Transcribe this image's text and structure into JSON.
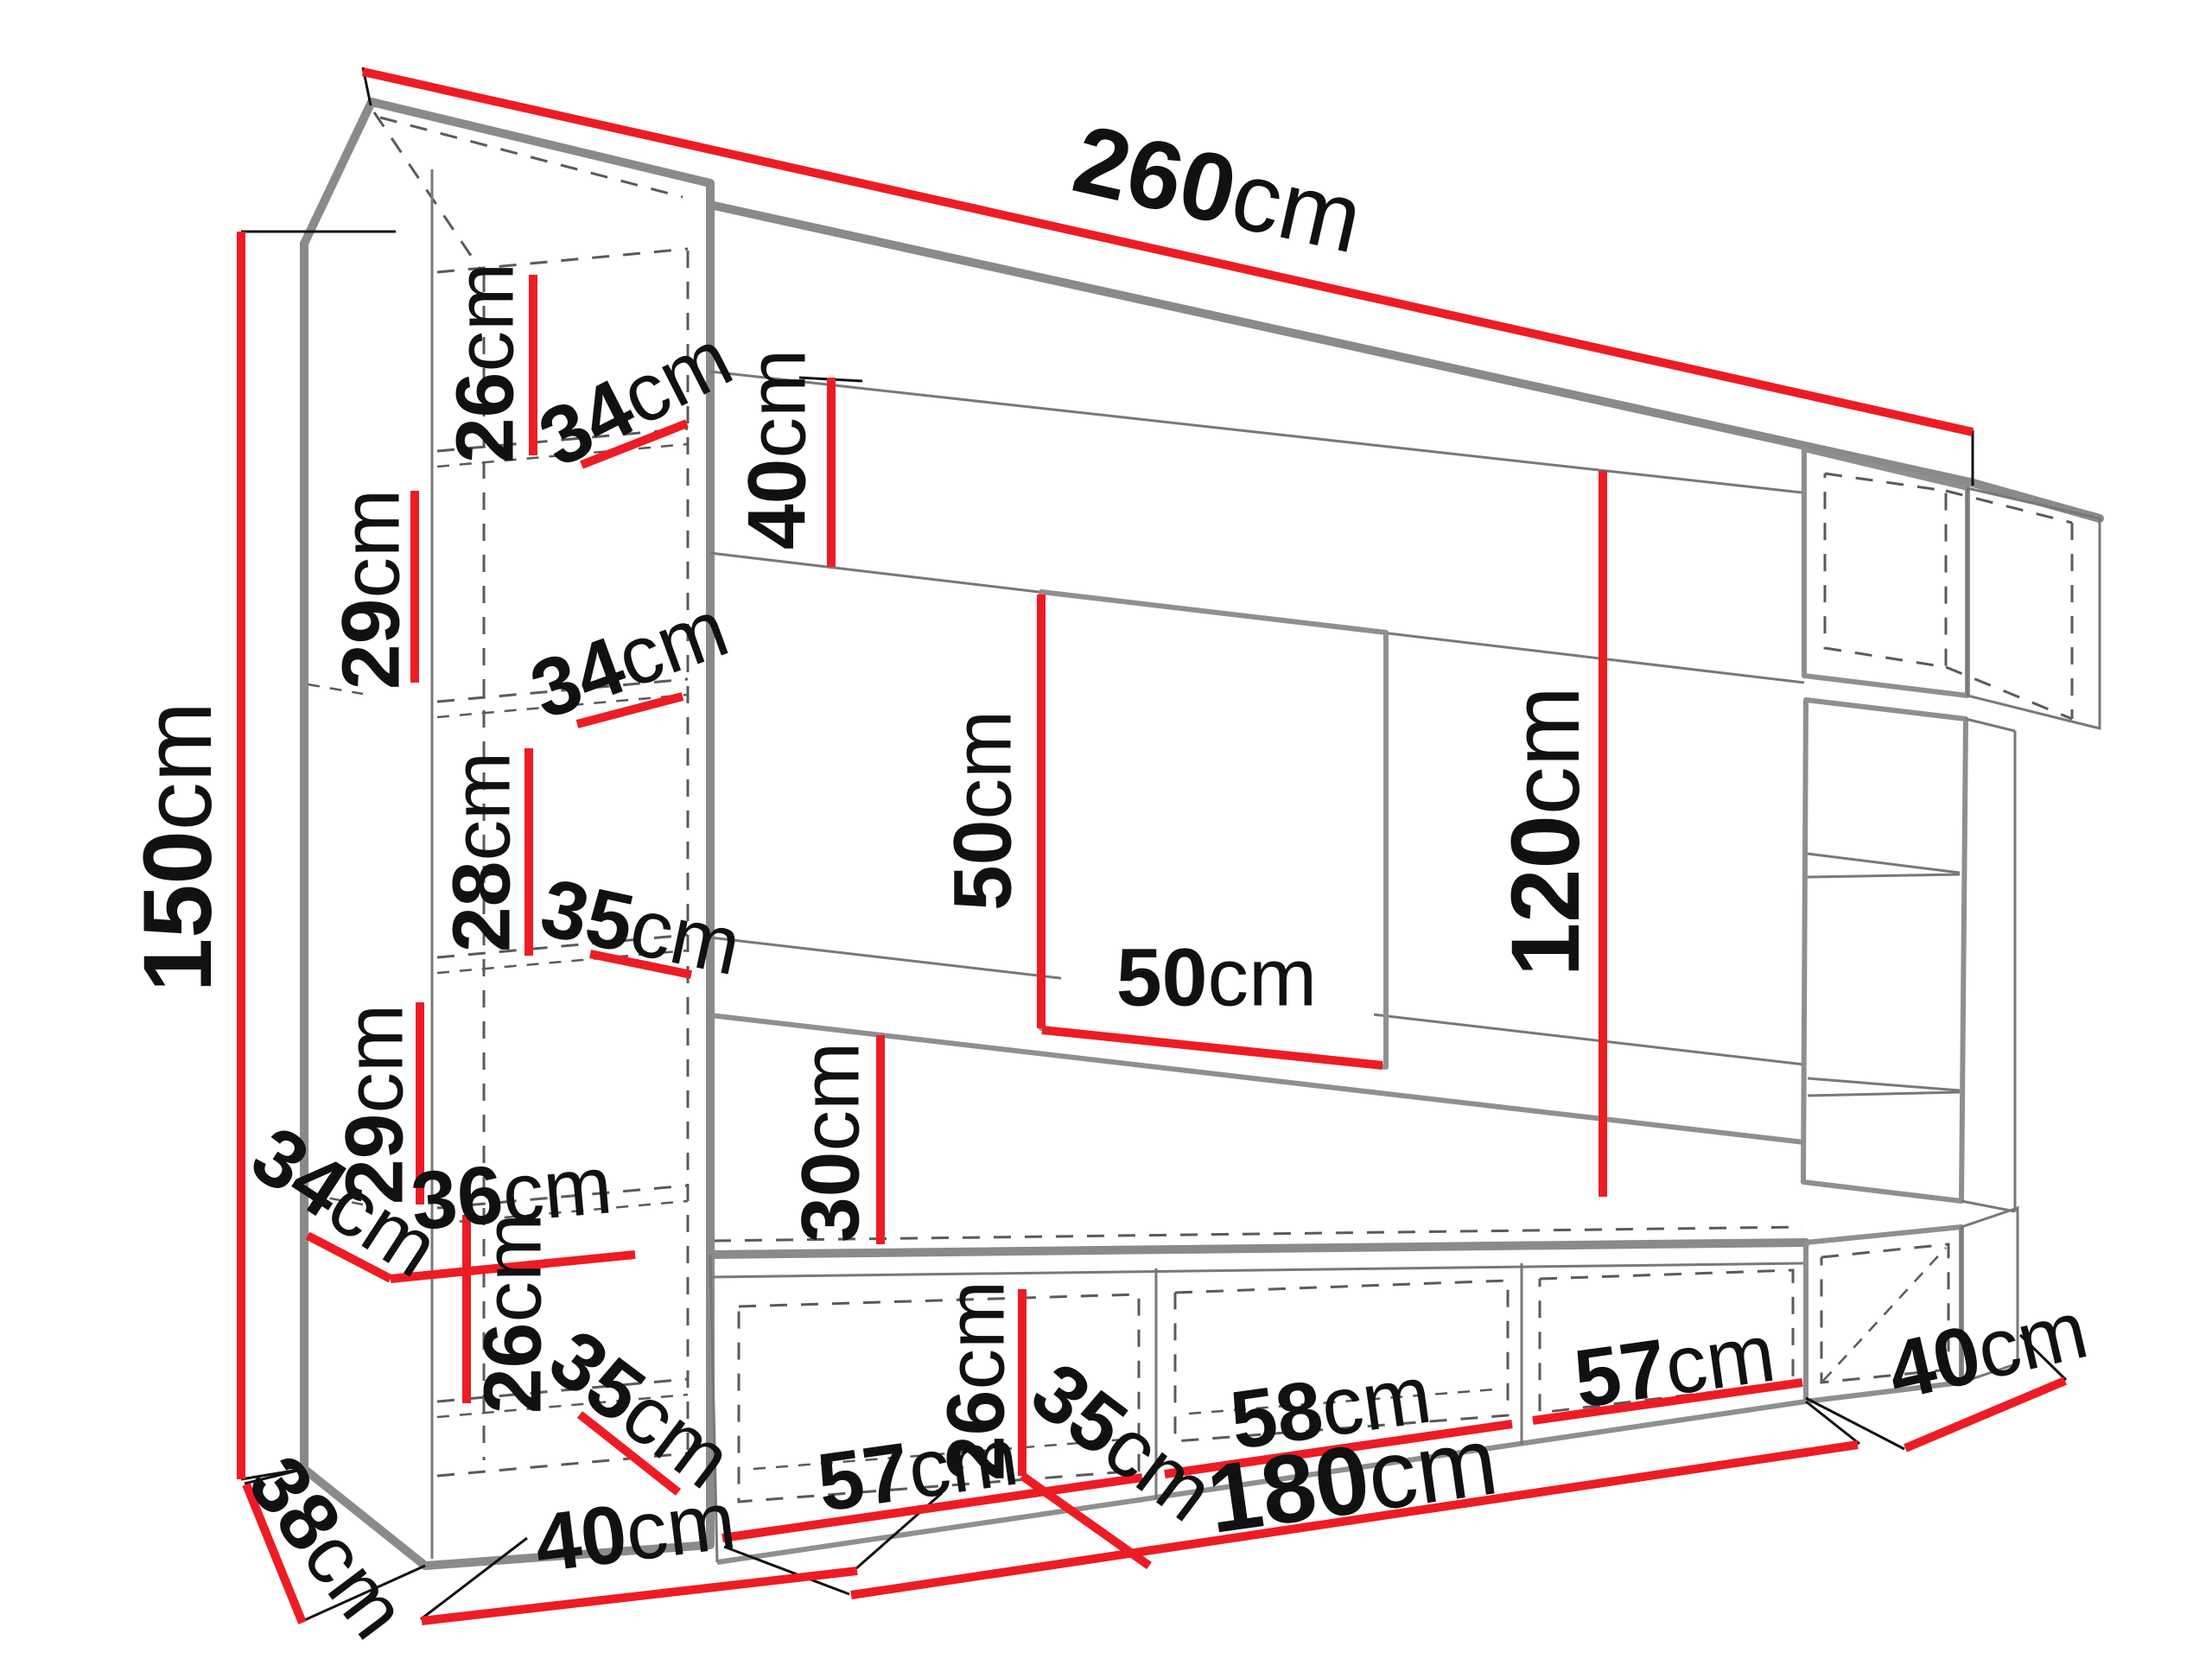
{
  "title": "Wall unit dimension diagram",
  "colors": {
    "dimension_line": "#ED1C24",
    "structure": "#8A8A8A",
    "hidden_edge": "#5A5A5A",
    "label_text": "#111111",
    "background": "#FFFFFF"
  },
  "dims": {
    "overall_width": {
      "value": "260",
      "unit": "cm"
    },
    "overall_height": {
      "value": "150",
      "unit": "cm"
    },
    "left_shelf1_height": {
      "value": "26",
      "unit": "cm"
    },
    "left_shelf1_depth": {
      "value": "34",
      "unit": "cm"
    },
    "left_shelf2_height": {
      "value": "29",
      "unit": "cm"
    },
    "left_shelf2_depth": {
      "value": "34",
      "unit": "cm"
    },
    "left_shelf3_height": {
      "value": "28",
      "unit": "cm"
    },
    "left_shelf3_depth": {
      "value": "35",
      "unit": "cm"
    },
    "left_shelf4_height": {
      "value": "29",
      "unit": "cm"
    },
    "left_bottom_depth": {
      "value": "34",
      "unit": "cm"
    },
    "left_bottom_width": {
      "value": "36",
      "unit": "cm"
    },
    "left_bottom_height": {
      "value": "26",
      "unit": "cm"
    },
    "left_bottom_inner_depth": {
      "value": "35",
      "unit": "cm"
    },
    "base_depth_left": {
      "value": "38",
      "unit": "cm"
    },
    "base_width_left": {
      "value": "40",
      "unit": "cm"
    },
    "top_panel_height": {
      "value": "40",
      "unit": "cm"
    },
    "tv_height": {
      "value": "50",
      "unit": "cm"
    },
    "tv_width": {
      "value": "50",
      "unit": "cm"
    },
    "wall_gap_height": {
      "value": "30",
      "unit": "cm"
    },
    "right_column_height": {
      "value": "120",
      "unit": "cm"
    },
    "stand_inner_height": {
      "value": "26",
      "unit": "cm"
    },
    "stand_inner_depth": {
      "value": "35",
      "unit": "cm"
    },
    "stand_compartment1_width": {
      "value": "57",
      "unit": "cm"
    },
    "stand_compartment2_width": {
      "value": "58",
      "unit": "cm"
    },
    "stand_compartment3_width": {
      "value": "57",
      "unit": "cm"
    },
    "base_depth_right": {
      "value": "40",
      "unit": "cm"
    },
    "stand_total_width": {
      "value": "180",
      "unit": "cm"
    }
  }
}
